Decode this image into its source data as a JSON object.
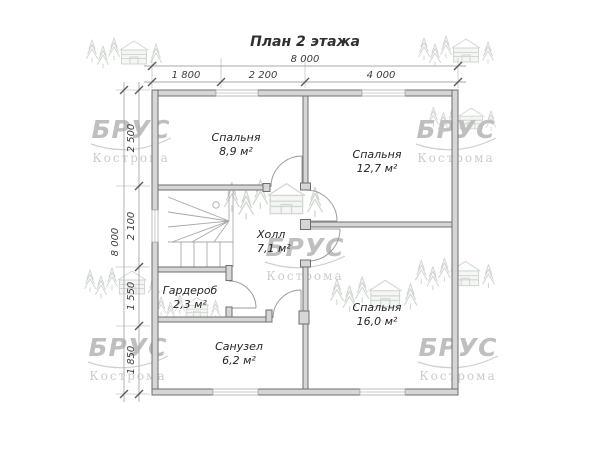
{
  "title": "План 2 этажа",
  "watermark": {
    "brand": "БРУС",
    "city": "Кострома"
  },
  "dimensions": {
    "top": {
      "total": "8 000",
      "segments": [
        "1 800",
        "2 200",
        "4 000"
      ]
    },
    "left": {
      "total": "8 000",
      "segments": [
        "2 500",
        "2 100",
        "1 550",
        "1 850"
      ]
    }
  },
  "rooms": [
    {
      "name": "Спальня",
      "area": "8,9 м²"
    },
    {
      "name": "Спальня",
      "area": "12,7 м²"
    },
    {
      "name": "Холл",
      "area": "7,1 м²"
    },
    {
      "name": "Гардероб",
      "area": "2,3 м²"
    },
    {
      "name": "Санузел",
      "area": "6,2 м²"
    },
    {
      "name": "Спальня",
      "area": "16,0 м²"
    }
  ],
  "colors": {
    "background": "#ffffff",
    "wall_fill": "#d6d6d6",
    "wall_outline": "#6f6f6f",
    "dimension_text": "#3d3d3d",
    "label_text": "#262626",
    "watermark_logo": "#bfbfbf",
    "watermark_sketch": "#ccd3cc"
  }
}
